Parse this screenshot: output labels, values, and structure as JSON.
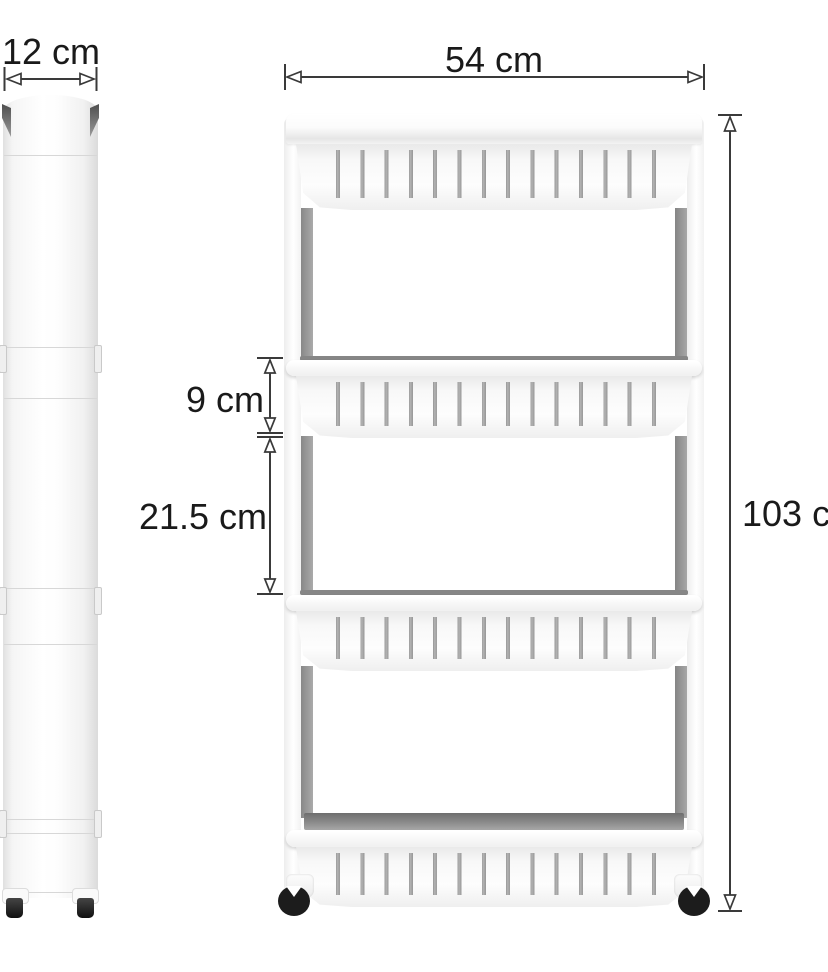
{
  "diagram": {
    "side_view": {
      "width_label": "12 cm"
    },
    "front_view": {
      "width_label": "54 cm",
      "height_label": "103 cm",
      "basket_height_label": "9 cm",
      "clearance_label": "21.5 cm"
    },
    "colors": {
      "dimension_line": "#3a3a3a",
      "text": "#1a1a1a",
      "cart_white": "#fdfdfd",
      "slot_gray": "#989898",
      "pole_gray": "#8a8a8a",
      "wheel_black": "#1c1c1c"
    }
  }
}
